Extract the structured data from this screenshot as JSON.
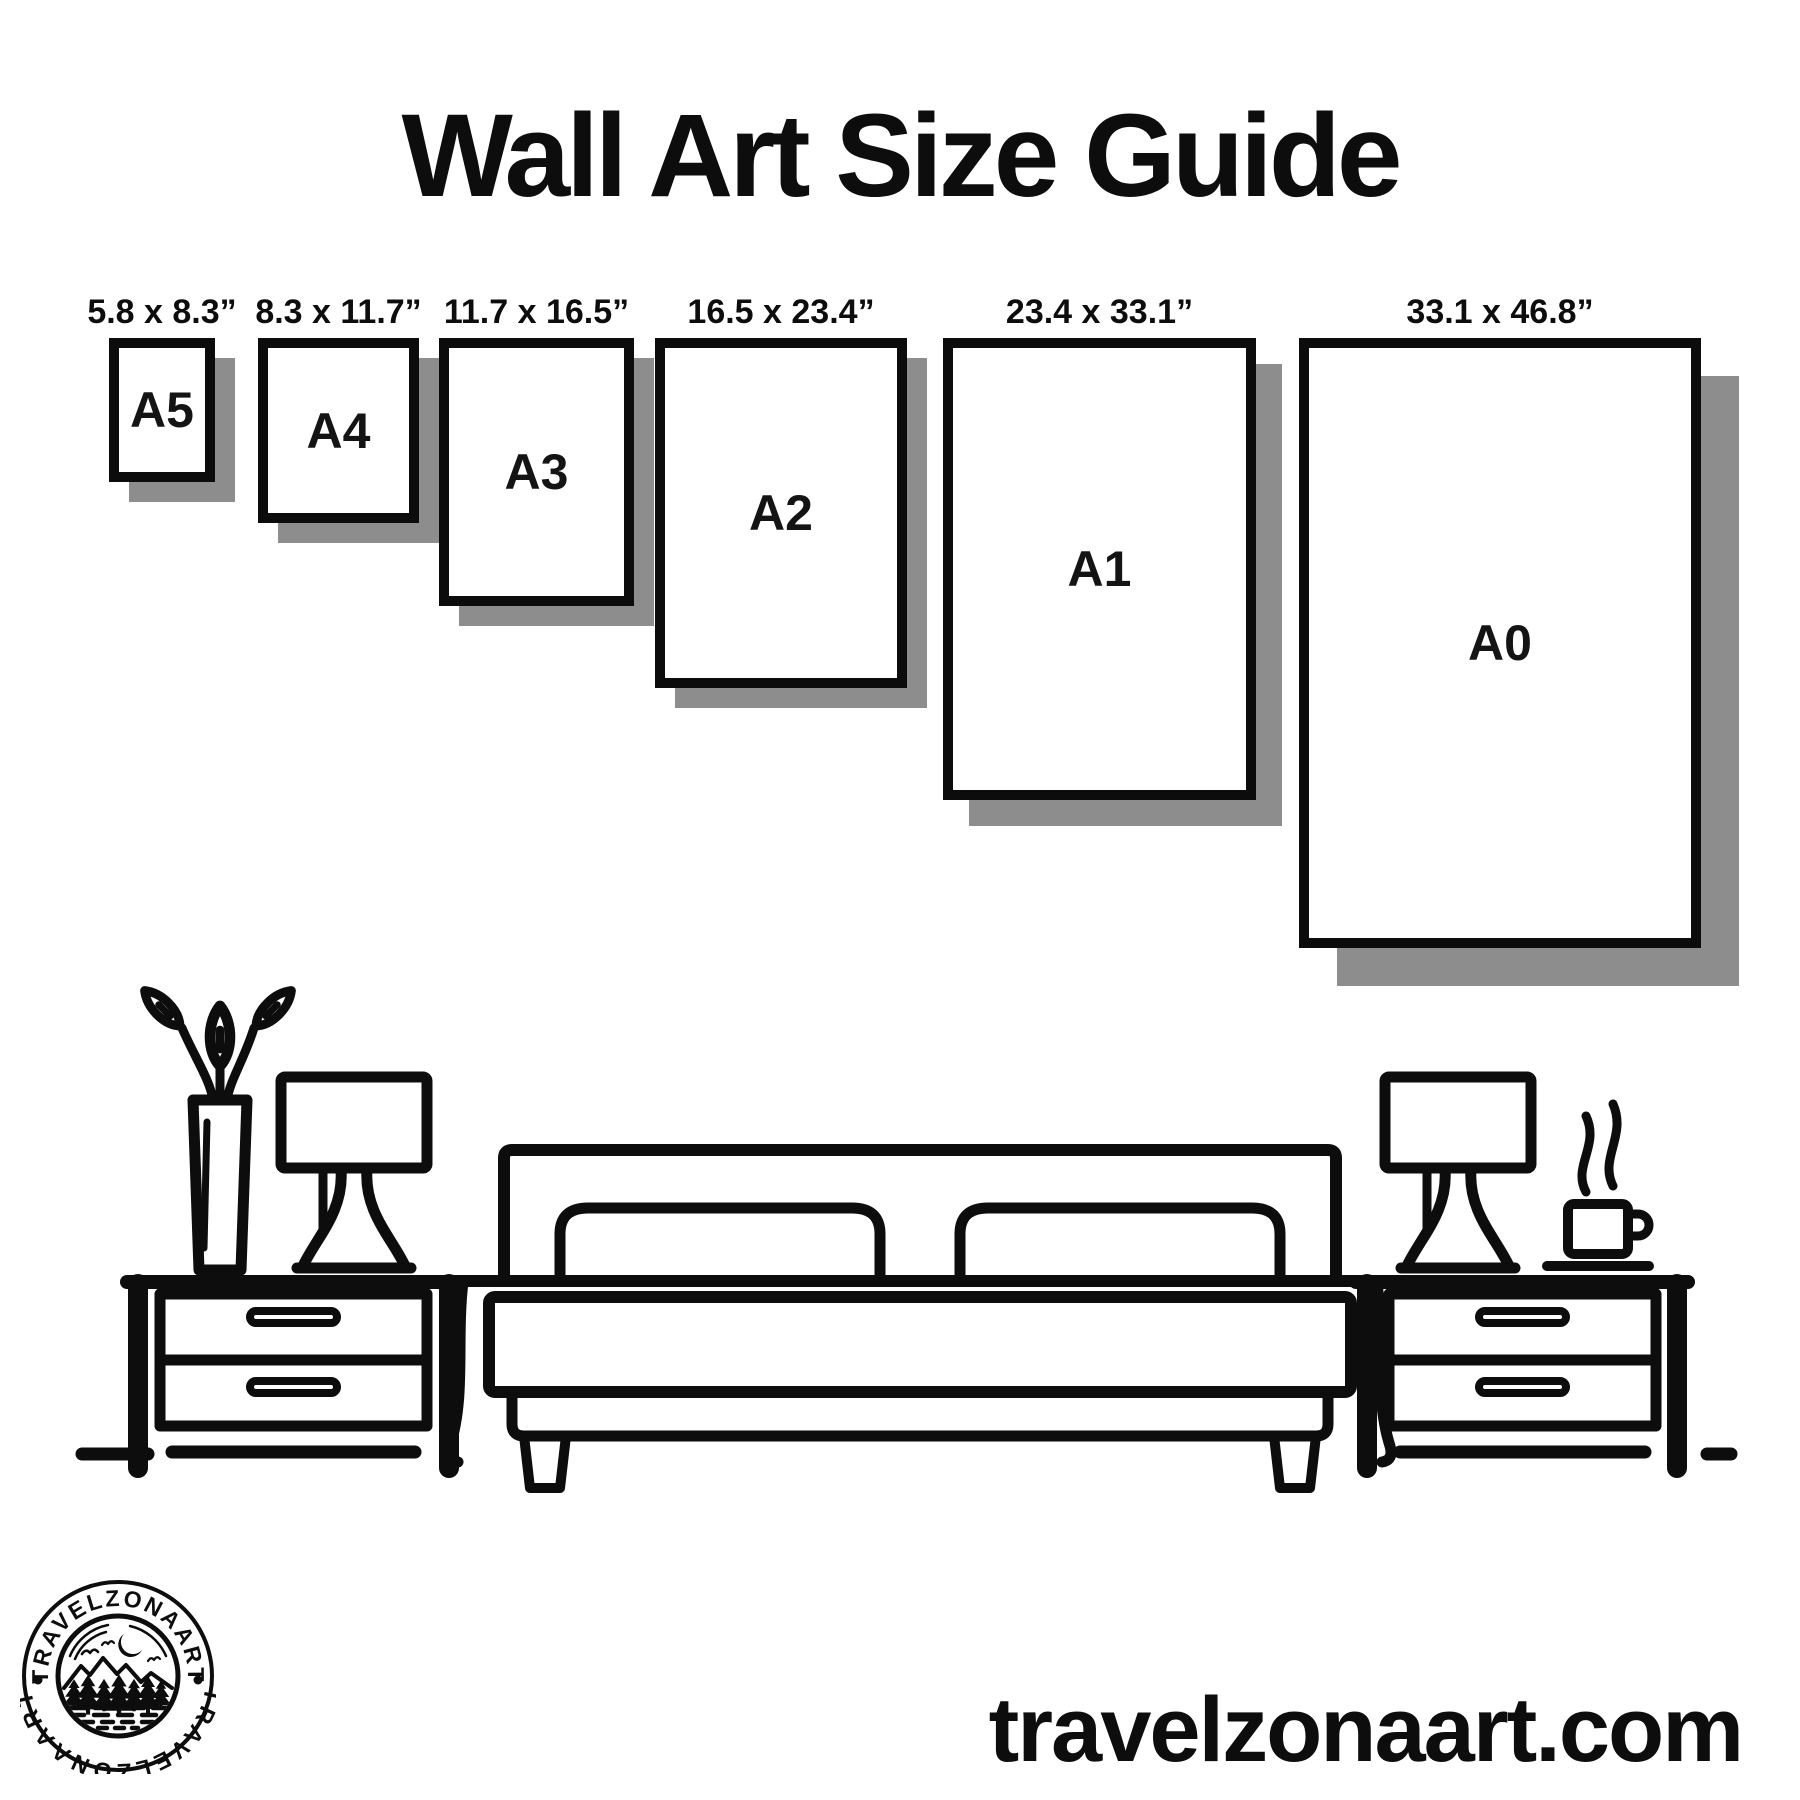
{
  "title": "Wall Art Size Guide",
  "sizes": [
    {
      "code": "A5",
      "dimensions": "5.8 x 8.3”"
    },
    {
      "code": "A4",
      "dimensions": "8.3 x 11.7”"
    },
    {
      "code": "A3",
      "dimensions": "11.7 x 16.5”"
    },
    {
      "code": "A2",
      "dimensions": "16.5 x 23.4”"
    },
    {
      "code": "A1",
      "dimensions": "23.4 x 33.1”"
    },
    {
      "code": "A0",
      "dimensions": "33.1 x 46.8”"
    }
  ],
  "logo": {
    "badge_text_top": "TRAVELZONAART",
    "badge_text_bottom": "TRAVELZONAART"
  },
  "footer": {
    "website": "travelzonaart.com"
  },
  "colors": {
    "ink": "#0d0d0d",
    "frame_border": "#0c0c0c",
    "frame_shadow": "#8d8d8d",
    "background": "#ffffff"
  },
  "illustration": {
    "scene": "bedroom-line-art",
    "objects": [
      "potted-plant",
      "table-lamp",
      "nightstand",
      "bed-with-two-pillows",
      "nightstand",
      "table-lamp",
      "steaming-coffee-cup",
      "floor-line"
    ]
  }
}
